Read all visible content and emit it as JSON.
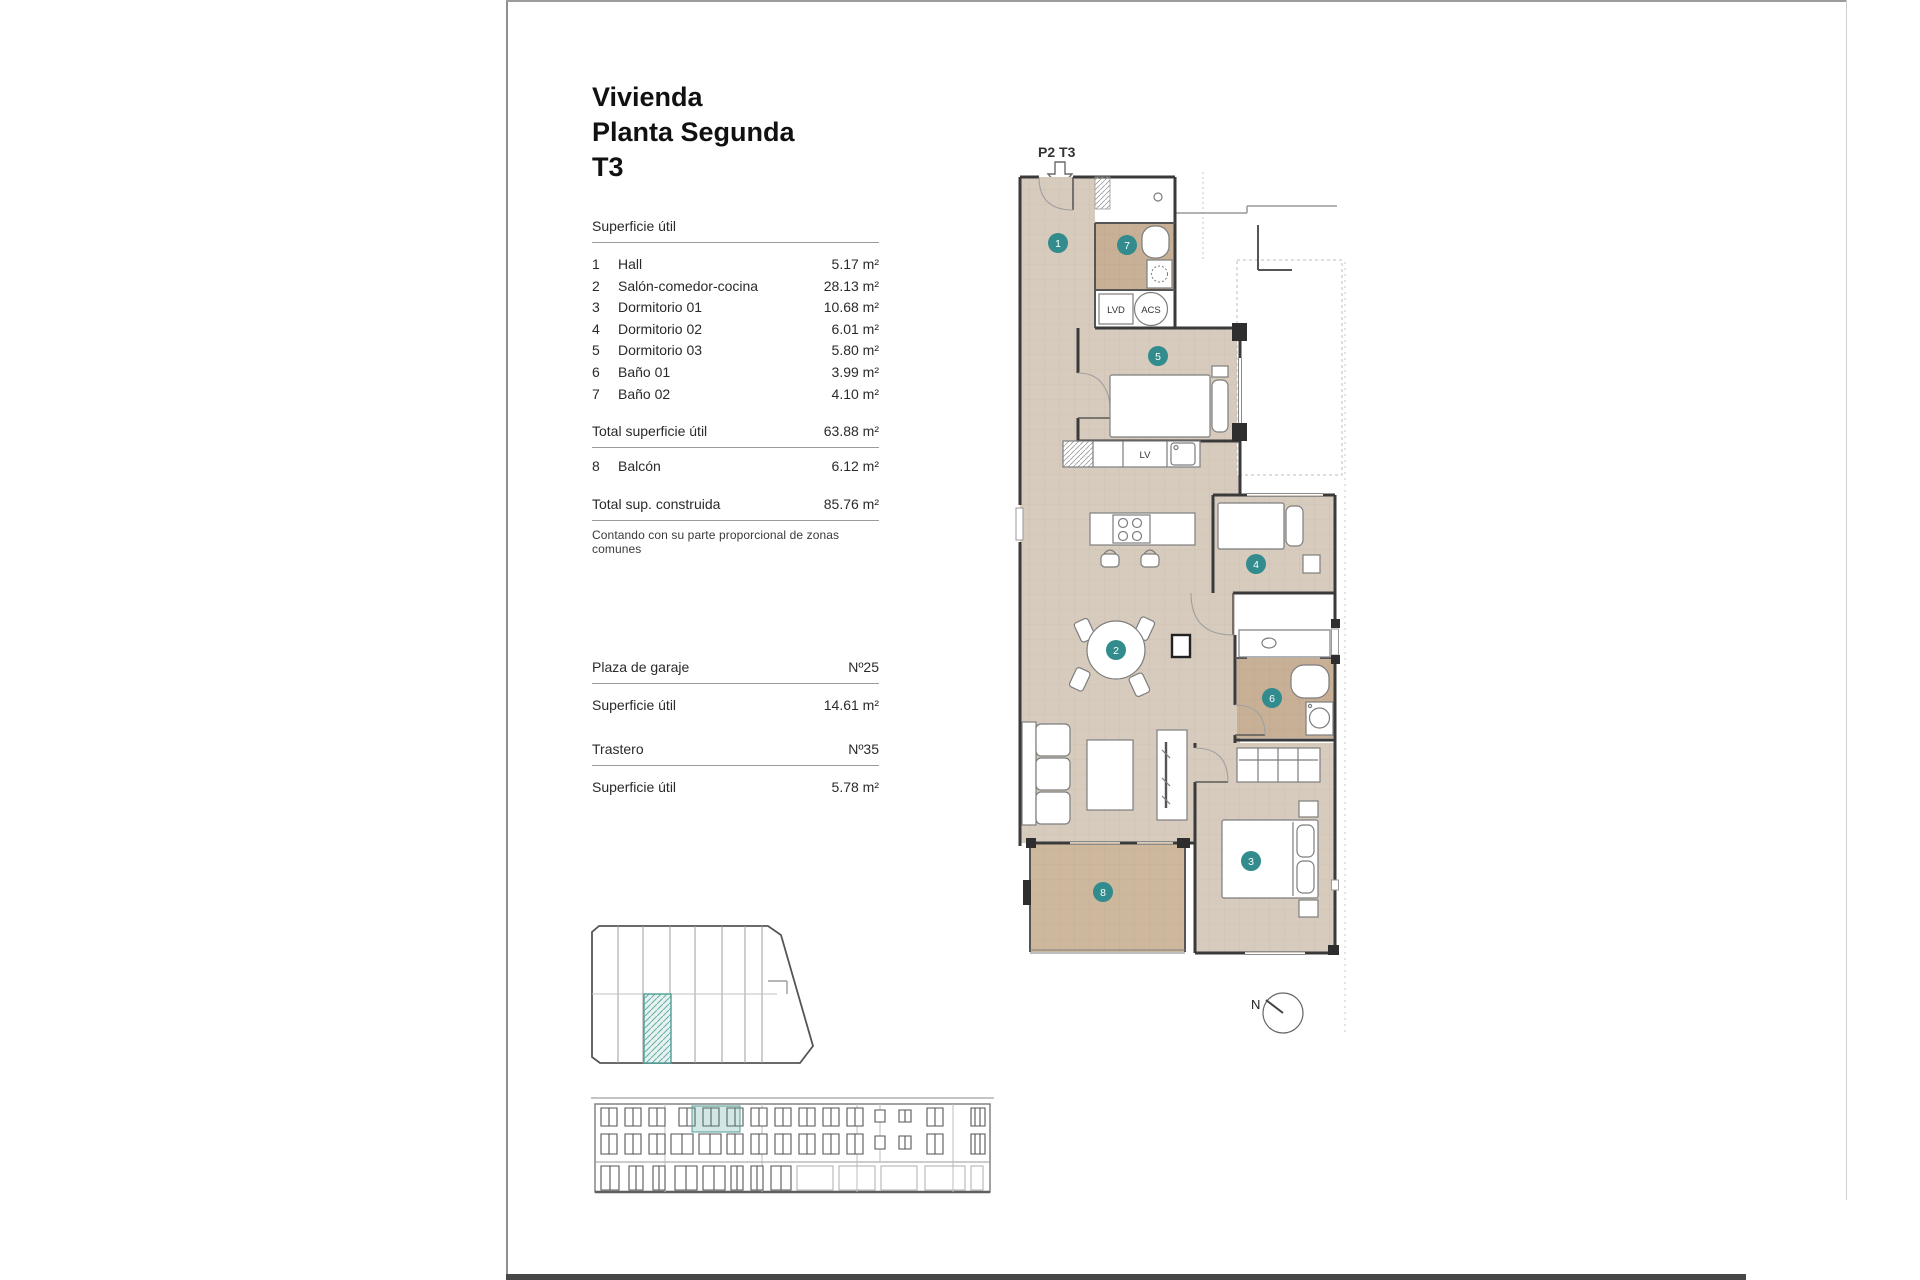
{
  "title": {
    "line1": "Vivienda",
    "line2": "Planta Segunda",
    "line3": "T3"
  },
  "areas": {
    "header": "Superficie útil",
    "rows": [
      {
        "num": "1",
        "label": "Hall",
        "value": "5.17 m²"
      },
      {
        "num": "2",
        "label": "Salón-comedor-cocina",
        "value": "28.13 m²"
      },
      {
        "num": "3",
        "label": "Dormitorio 01",
        "value": "10.68 m²"
      },
      {
        "num": "4",
        "label": "Dormitorio 02",
        "value": "6.01 m²"
      },
      {
        "num": "5",
        "label": "Dormitorio 03",
        "value": "5.80 m²"
      },
      {
        "num": "6",
        "label": "Baño 01",
        "value": "3.99 m²"
      },
      {
        "num": "7",
        "label": "Baño 02",
        "value": "4.10 m²"
      }
    ],
    "total_label": "Total superficie útil",
    "total_value": "63.88 m²",
    "balcony": {
      "num": "8",
      "label": "Balcón",
      "value": "6.12 m²"
    },
    "built_label": "Total sup. construida",
    "built_value": "85.76 m²",
    "note": "Contando con su parte proporcional de zonas comunes"
  },
  "garage": {
    "label": "Plaza de garaje",
    "number": "Nº25",
    "area_label": "Superficie útil",
    "area_value": "14.61 m²"
  },
  "storage": {
    "label": "Trastero",
    "number": "Nº35",
    "area_label": "Superficie útil",
    "area_value": "5.78 m²"
  },
  "plan": {
    "unit_label": "P2 T3",
    "rooms": {
      "hall": "1",
      "living": "2",
      "dorm1": "3",
      "dorm2": "4",
      "dorm3": "5",
      "bath1": "6",
      "bath2": "7",
      "balcony": "8"
    },
    "labels": {
      "lvd": "LVD",
      "acs": "ACS",
      "lv": "LV"
    },
    "compass": "N"
  },
  "colors": {
    "teal_badge": "#328b8c",
    "floor_tile": "#d7cbbd",
    "bath_tile": "#c8b096",
    "balcony_tile": "#cdb89e",
    "unit_highlight": "#4f9e97"
  }
}
